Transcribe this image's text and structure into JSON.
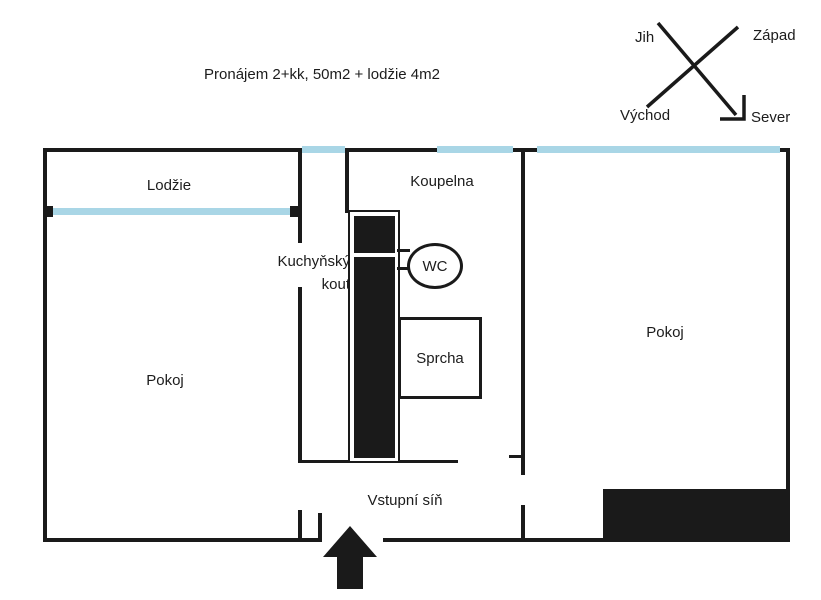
{
  "title": "Pronájem 2+kk, 50m2 + lodžie 4m2",
  "compass": {
    "jih": "Jih",
    "zapad": "Západ",
    "vychod": "Východ",
    "sever": "Sever"
  },
  "rooms": {
    "lodzie": "Lodžie",
    "koupelna": "Koupelna",
    "kuchynsky_kout": "Kuchyňský kout",
    "wc": "WC",
    "sprcha": "Sprcha",
    "pokoj_left": "Pokoj",
    "pokoj_right": "Pokoj",
    "vstupni_sin": "Vstupní síň"
  },
  "colors": {
    "wall": "#1a1a1a",
    "window": "#a9d6e6",
    "background": "#ffffff",
    "text": "#1c1c1c"
  }
}
